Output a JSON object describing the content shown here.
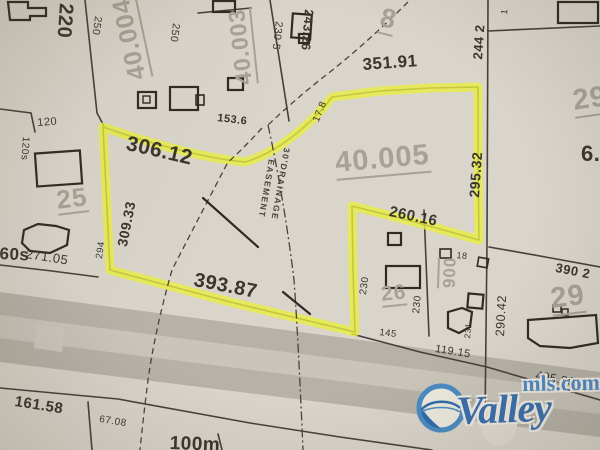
{
  "meta": {
    "type": "plat-parcel-map-photo",
    "highlighted_parcel": "40.005",
    "colors": {
      "paper": "#d9d5cb",
      "highlight_yellow": "#e9ee3e",
      "road_gray": "#b6b2a8",
      "road_light": "#c9c5bb",
      "ink": "#3a352d",
      "parcel_id_gray": "#a7a196",
      "logo_blue": "#3a6fad",
      "logo_light_blue": "#4e89c6"
    }
  },
  "parcel_ids": {
    "a40004": "40.004",
    "a40003": "40.003",
    "a8": "8",
    "a40005": "40.005",
    "p25": "25",
    "p26": "26",
    "p006": "006",
    "p29_top": "29",
    "p29_bottom": "29"
  },
  "dimensions": {
    "d220": "220",
    "d250a": "250",
    "d250b": "250",
    "d2305": "230 5",
    "d24326": "243.26",
    "d2442": "244 2",
    "d1": "1",
    "d35191": "351.91",
    "d30612": "306.12",
    "d1536": "153.6",
    "d178": "17.8",
    "d29532": "295.32",
    "d30933": "309.33",
    "d294": "294",
    "d27105": "271.05",
    "d120": "120",
    "d120s": "120s",
    "d60s": "60s",
    "d26016": "260.16",
    "d39387": "393.87",
    "d230a": "230",
    "d230b": "230",
    "d145": "145",
    "d18": "18",
    "d231": "231",
    "d29042": "290.42",
    "d3902": "390 2",
    "d11915": "119.15",
    "d40586": "405.86",
    "d16158": "161.58",
    "d6708": "67.08",
    "d6": "6."
  },
  "easement": {
    "line1": "30'DRAINAGE",
    "line2": "EASEMENT"
  },
  "scale_label": "100m",
  "logo": {
    "brand": "Valley",
    "domain": "mls.com"
  }
}
